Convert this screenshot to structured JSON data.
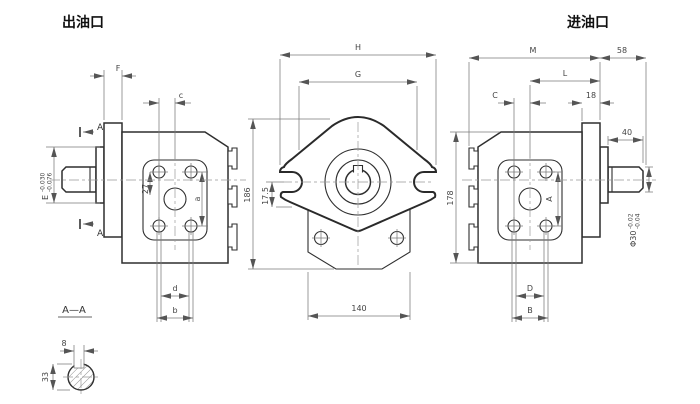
{
  "titles": {
    "outlet_port": "出油口",
    "inlet_port": "进油口"
  },
  "section": {
    "title": "A—A"
  },
  "view_arrows": {
    "label": "A"
  },
  "dims": {
    "F": "F",
    "c": "c",
    "a": "a",
    "n27": "27",
    "d": "d",
    "b": "b",
    "E": "E",
    "E_tol_upper": "-0.030",
    "E_tol_lower": "-0.076",
    "H": "H",
    "G": "G",
    "n186": "186",
    "n17_5": "17.5",
    "n140": "140",
    "n178": "178",
    "M": "M",
    "n58": "58",
    "L": "L",
    "C": "C",
    "n18": "18",
    "n40": "40",
    "A": "A",
    "D": "D",
    "B": "B",
    "phi": "Φ30",
    "phi_tol_upper": "-0.02",
    "phi_tol_lower": "-0.04",
    "n8": "8",
    "n33": "33"
  }
}
